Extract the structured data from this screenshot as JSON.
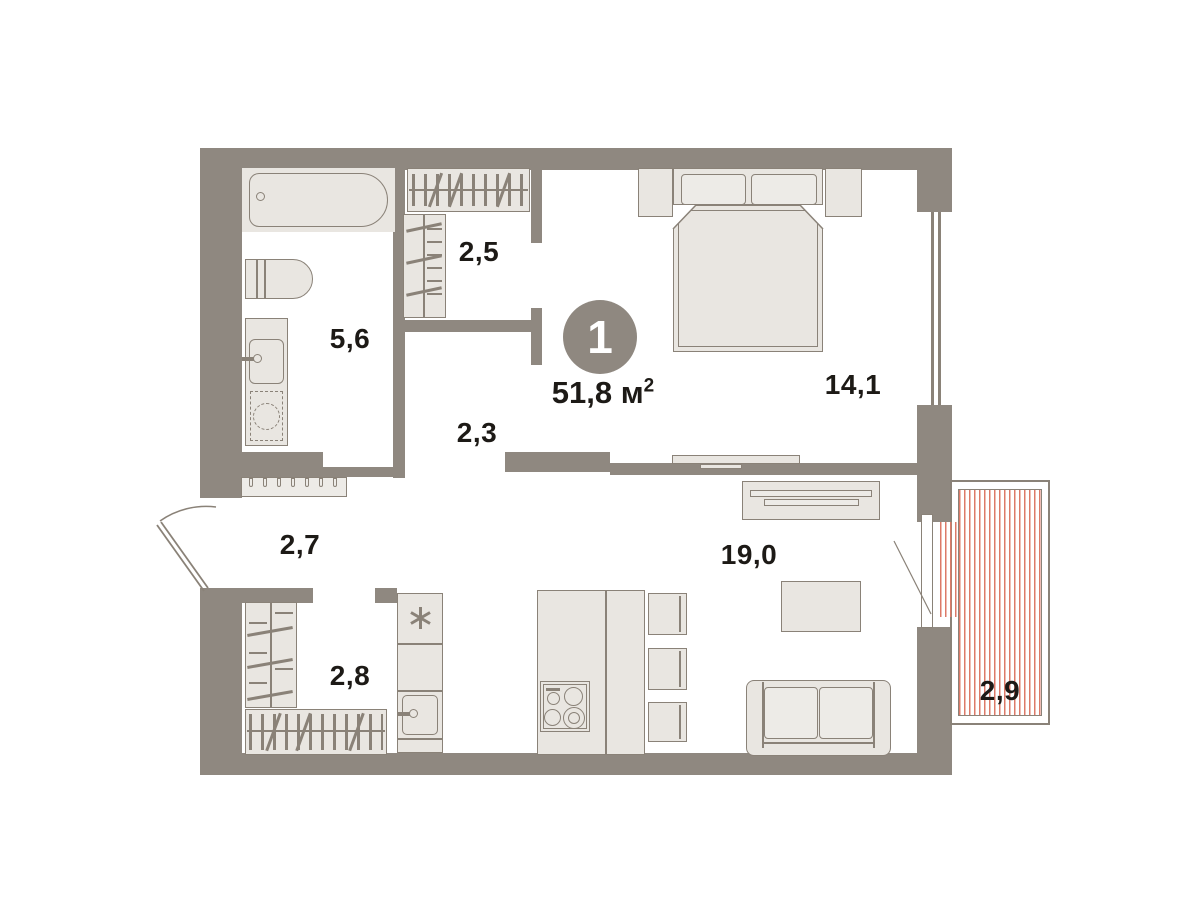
{
  "title": "1-room apartment floor plan",
  "badge": {
    "rooms_count": "1"
  },
  "total_area": {
    "value": "51,8",
    "unit": "м",
    "superscript": "2"
  },
  "room_labels": {
    "bathroom": "5,6",
    "wardrobe_top": "2,5",
    "hallway_inner": "2,3",
    "bedroom": "14,1",
    "hallway_entry": "2,7",
    "wardrobe_bottom": "2,8",
    "living_kitchen": "19,0",
    "balcony": "2,9"
  },
  "rooms": [
    {
      "name": "bathroom",
      "area": "5,6"
    },
    {
      "name": "wardrobe-top",
      "area": "2,5"
    },
    {
      "name": "inner-hallway",
      "area": "2,3"
    },
    {
      "name": "bedroom",
      "area": "14,1"
    },
    {
      "name": "entry-hallway",
      "area": "2,7"
    },
    {
      "name": "wardrobe-bottom",
      "area": "2,8"
    },
    {
      "name": "living-kitchen",
      "area": "19,0"
    },
    {
      "name": "balcony",
      "area": "2,9"
    }
  ],
  "colors": {
    "wall": "#8F8880",
    "furniture_stroke": "#8A8278",
    "furniture_fill": "#E9E6E1",
    "furniture_fill_light": "#EDEBE7",
    "balcony_hatch": "#DC7A68",
    "text": "#1D1A16",
    "badge_background": "#8F8880",
    "badge_text": "#FFFFFF",
    "background": "#FFFFFF"
  },
  "icons": {
    "fridge": "asterisk-star-icon",
    "entrance_door": "door-swing-arc-icon",
    "balcony_door": "door-leaf-diagonal-icon"
  }
}
